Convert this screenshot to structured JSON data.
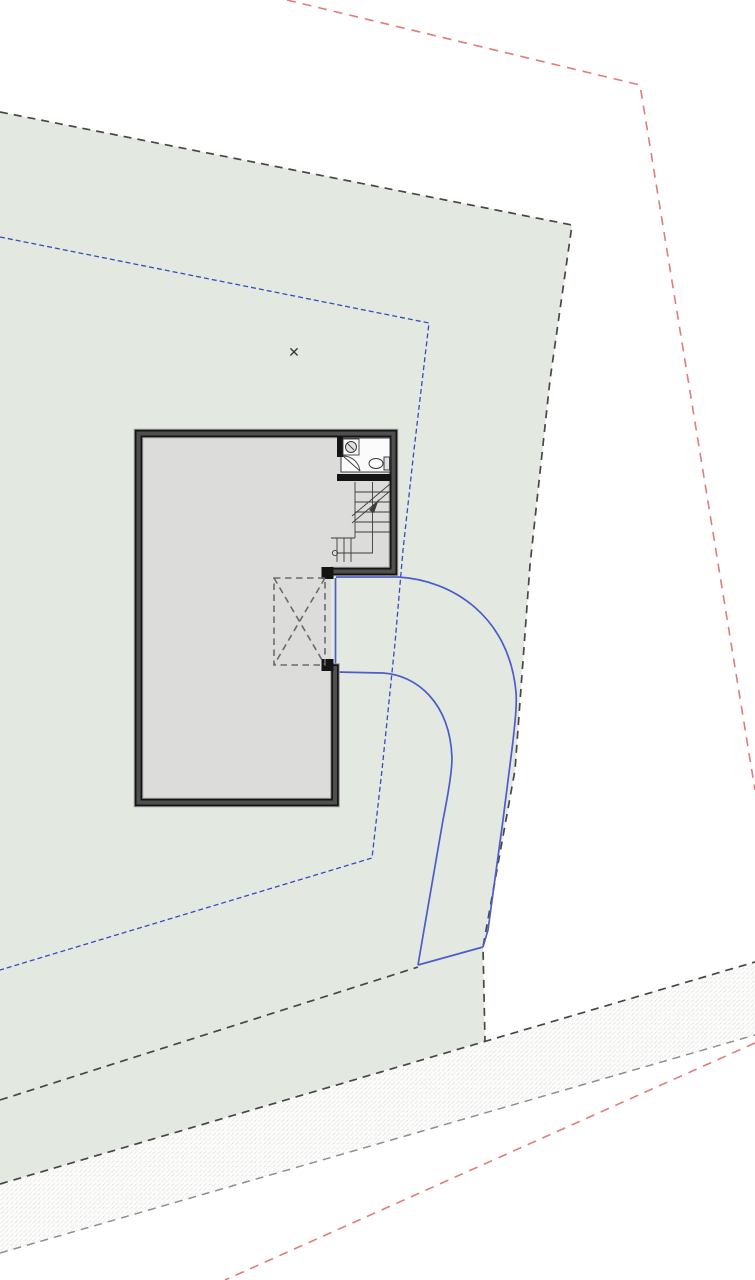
{
  "marker": {
    "glyph": "✕"
  },
  "colors": {
    "page_bg": "#ffffff",
    "site_green": "#e3e9e0",
    "boundary_gray": "#474747",
    "hatch_border_gray": "#8f8f8f",
    "hatch_dot_gray": "#dadada",
    "hatch_bg": "#f3f3f1",
    "red_boundary": "#e07c7c",
    "blue_setback": "#3b49c1",
    "blue_path": "#4d5bcb",
    "wall_halo": "#9a9a9a",
    "wall_dark": "#141414",
    "wall_core": "#4f4f4f",
    "floor_gray": "#dcddda",
    "detail_line": "#3c3c3c",
    "fixture_white": "#fbfbfb",
    "marker_color": "#3a3a3a"
  }
}
